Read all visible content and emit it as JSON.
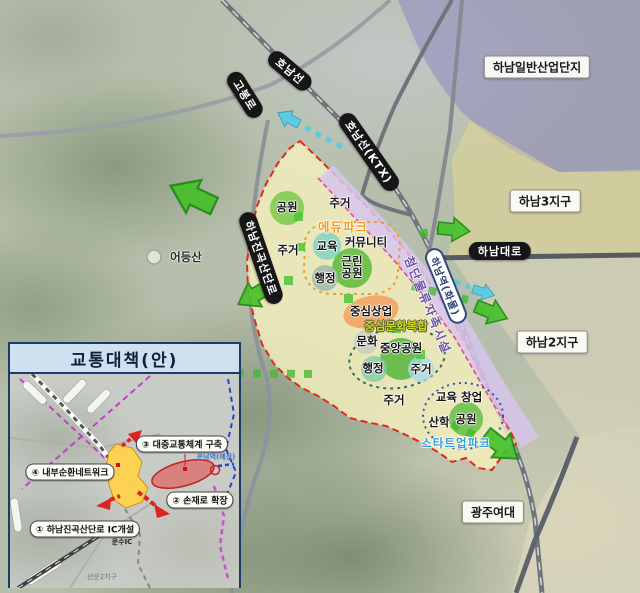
{
  "map": {
    "regions": {
      "industrial_complex": "하남일반산업단지",
      "hanam3": "하남3지구",
      "hanam2": "하남2지구",
      "gwangju_womens_univ": "광주여대",
      "eodeungsan": "어등산",
      "logistics_band": "첨단물류자족시설"
    },
    "roads": {
      "honam_line": "호남선",
      "gobong_ro": "고봉로",
      "honam_ktx": "호남선(KTX)",
      "hanam_daero": "하남대로",
      "jingok_sandan_ro": "하남진곡산단로",
      "hanam_station": "하남역(화물)"
    },
    "zones": {
      "park_nw": "공원",
      "residential_top": "주거",
      "edu_park": "에듀파크",
      "education": "교육",
      "community": "커뮤니티",
      "neighborhood_park": "근린공원",
      "admin_1": "행정",
      "residential_left": "주거",
      "central_commercial": "중심상업",
      "central_culture": "중심문화복합",
      "culture": "문화",
      "central_park": "중앙공원",
      "admin_2": "행정",
      "residential_mid": "주거",
      "residential_south": "주거",
      "edu_startup": "교육 창업",
      "industry_academia": "산학",
      "park_se": "공원",
      "startup_park": "스타트업파크"
    }
  },
  "inset": {
    "title": "교통대책(안)",
    "items": [
      {
        "label": "③ 대중교통체계 구축"
      },
      {
        "label": "④ 내부순환네트워크"
      },
      {
        "label": "② 손재로 확장"
      },
      {
        "label": "① 하남진곡산단로 IC개설"
      }
    ],
    "station": "운남역(예정)",
    "ic": "운수IC",
    "district": "선운2지구"
  },
  "colors": {
    "site_fill": "#f6f1bd",
    "site_boundary": "#dd2b20",
    "park_green": "#6cc04a",
    "commercial_orange": "#f2a868",
    "logistics_lavender": "#d7c4ec",
    "arrow_green": "#46c02c",
    "arrow_cyan": "#5ecbe2",
    "pill_black": "#161616",
    "inset_header_bg": "#cfe0f0",
    "inset_border": "#1e3a66"
  }
}
